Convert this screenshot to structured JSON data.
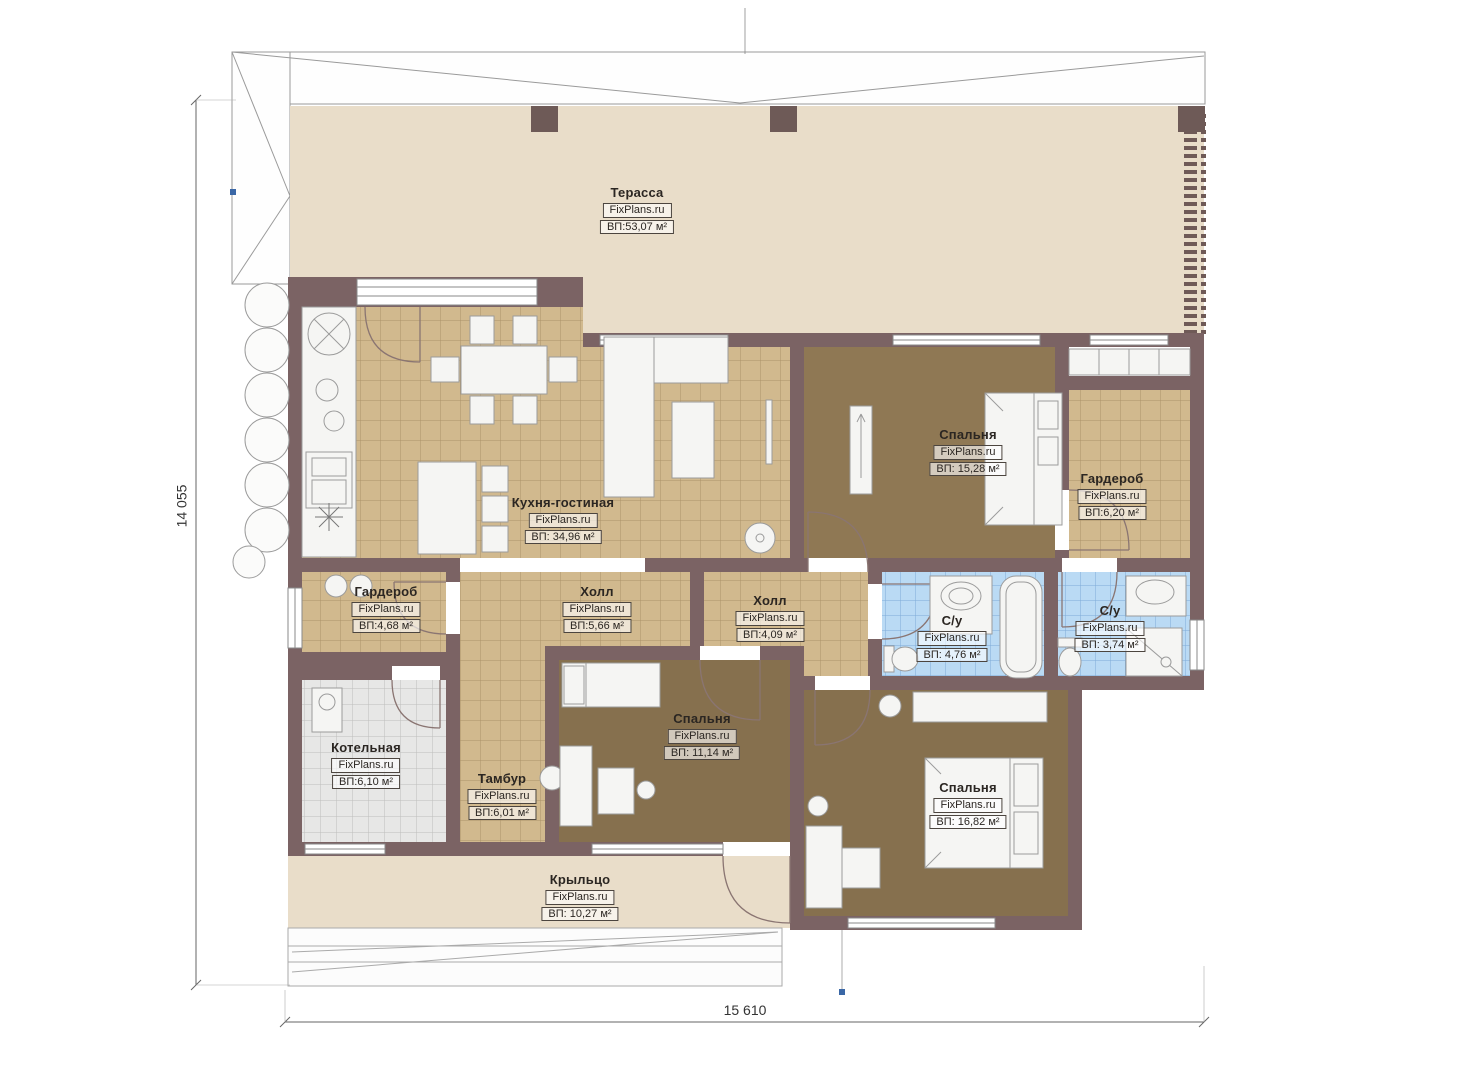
{
  "plan": {
    "type": "floor-plan",
    "watermark": "FixPlans.ru"
  },
  "dimensions": {
    "left_vertical": "14 055",
    "bottom_horizontal": "15 610"
  },
  "rooms": [
    {
      "name": "Терасса",
      "watermark": "FixPlans.ru",
      "area": "ВП:53,07 м²"
    },
    {
      "name": "Кухня-гостиная",
      "watermark": "FixPlans.ru",
      "area": "ВП: 34,96 м²"
    },
    {
      "name": "Спальня",
      "watermark": "FixPlans.ru",
      "area": "ВП: 15,28 м²"
    },
    {
      "name": "Гардероб",
      "watermark": "FixPlans.ru",
      "area": "ВП:6,20 м²"
    },
    {
      "name": "Холл",
      "watermark": "FixPlans.ru",
      "area": "ВП:5,66 м²"
    },
    {
      "name": "Холл",
      "watermark": "FixPlans.ru",
      "area": "ВП:4,09 м²"
    },
    {
      "name": "С/у",
      "watermark": "FixPlans.ru",
      "area": "ВП: 4,76 м²"
    },
    {
      "name": "С/у",
      "watermark": "FixPlans.ru",
      "area": "ВП: 3,74 м²"
    },
    {
      "name": "Гардероб",
      "watermark": "FixPlans.ru",
      "area": "ВП:4,68 м²"
    },
    {
      "name": "Котельная",
      "watermark": "FixPlans.ru",
      "area": "ВП:6,10 м²"
    },
    {
      "name": "Тамбур",
      "watermark": "FixPlans.ru",
      "area": "ВП:6,01 м²"
    },
    {
      "name": "Спальня",
      "watermark": "FixPlans.ru",
      "area": "ВП: 11,14 м²"
    },
    {
      "name": "Спальня",
      "watermark": "FixPlans.ru",
      "area": "ВП: 16,82 м²"
    },
    {
      "name": "Крыльцо",
      "watermark": "FixPlans.ru",
      "area": "ВП: 10,27 м²"
    }
  ],
  "colors": {
    "wall": "#7b6364",
    "terrace_floor": "#e9ddc9",
    "tile_floor": "#d1b98e",
    "carpet_floor": "#86704e",
    "carpet_floor_light": "#8f7854",
    "bath_floor": "#badaf4",
    "boiler_floor": "#e7e7e6",
    "axis_marker": "#3a67a6"
  }
}
